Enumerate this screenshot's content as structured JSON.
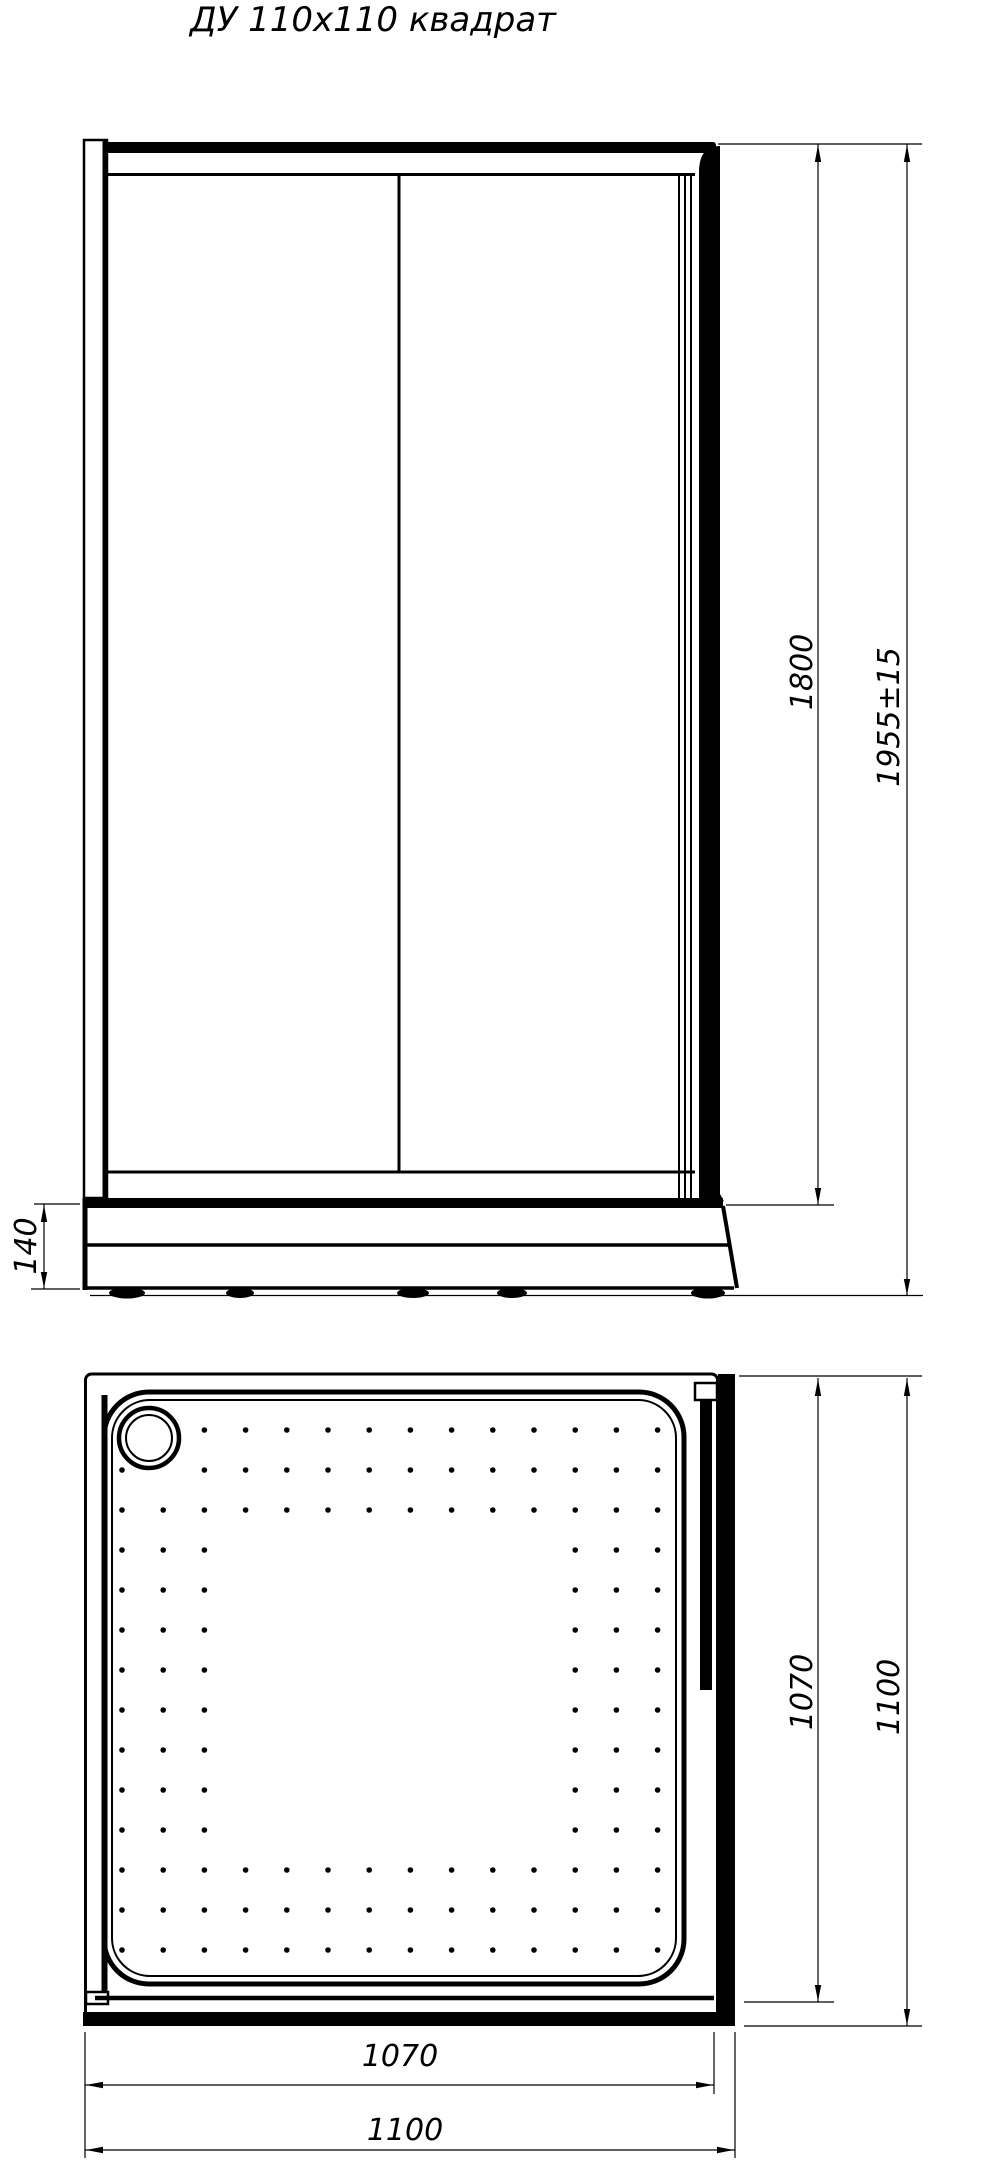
{
  "title": "ДУ 110x110 квадрат",
  "colors": {
    "ink": "#000000",
    "paper": "#ffffff"
  },
  "front_view": {
    "name": "front elevation of shower enclosure",
    "dim_door_height": "1800",
    "dim_total_height": "1955±15",
    "dim_tray_height": "140"
  },
  "plan_view": {
    "name": "shower tray plan",
    "dim_inner_depth": "1070",
    "dim_outer_depth": "1100",
    "dim_inner_width": "1070",
    "dim_outer_width": "1100",
    "tray_pattern": {
      "x0": 122,
      "y0": 1430,
      "dx": 41.2,
      "dy": 40,
      "cols": 14,
      "rows": 14,
      "border": 3,
      "dot_r": 2.8,
      "drain_cx": 149,
      "drain_cy": 1438,
      "drain_clear": 40
    }
  }
}
